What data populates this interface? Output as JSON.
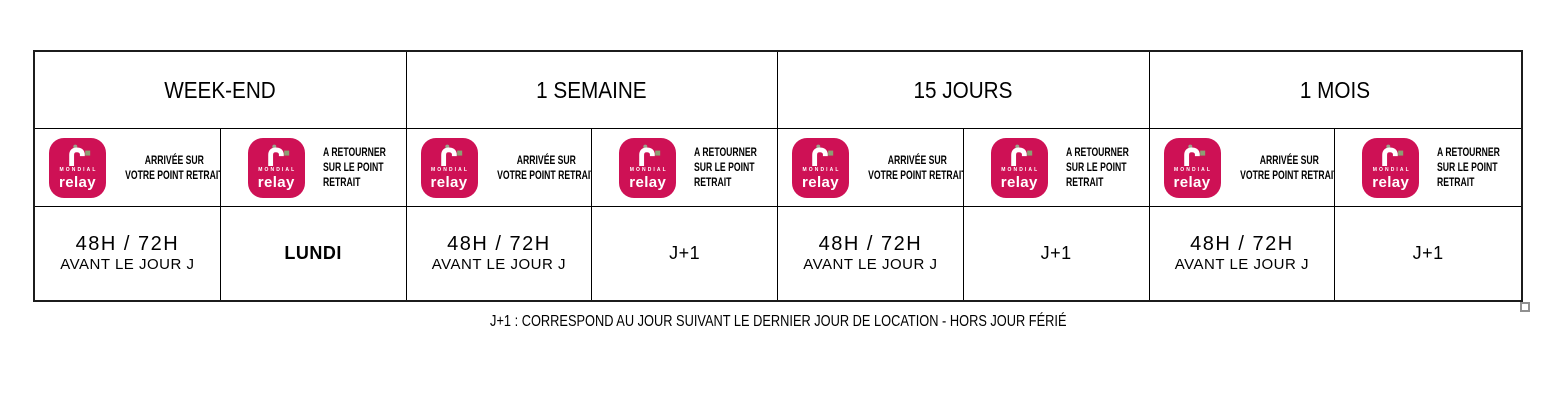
{
  "colors": {
    "brand_pink": "#ce1155",
    "brand_green": "#8c9e73",
    "dot_green": "#9ba68e"
  },
  "logo": {
    "brand_top": "MONDIAL",
    "brand_bottom": "relay"
  },
  "table": {
    "groups": [
      {
        "title": "WEEK-END",
        "arrival": {
          "label_line1": "ARRIVÉE SUR",
          "label_line2": "VOTRE POINT RETRAIT",
          "value_line1": "48H / 72H",
          "value_line2": "AVANT LE JOUR J"
        },
        "return": {
          "label_line1": "A RETOURNER",
          "label_line2": "SUR LE POINT",
          "label_line3": "RETRAIT",
          "value": "LUNDI"
        }
      },
      {
        "title": "1 SEMAINE",
        "arrival": {
          "label_line1": "ARRIVÉE SUR",
          "label_line2": "VOTRE POINT RETRAIT",
          "value_line1": "48H / 72H",
          "value_line2": "AVANT LE JOUR J"
        },
        "return": {
          "label_line1": "A RETOURNER",
          "label_line2": "SUR LE POINT",
          "label_line3": "RETRAIT",
          "value": "J+1"
        }
      },
      {
        "title": "15 JOURS",
        "arrival": {
          "label_line1": "ARRIVÉE SUR",
          "label_line2": "VOTRE POINT RETRAIT",
          "value_line1": "48H / 72H",
          "value_line2": "AVANT LE JOUR J"
        },
        "return": {
          "label_line1": "A RETOURNER",
          "label_line2": "SUR LE POINT",
          "label_line3": "RETRAIT",
          "value": "J+1"
        }
      },
      {
        "title": "1 MOIS",
        "arrival": {
          "label_line1": "ARRIVÉE SUR",
          "label_line2": "VOTRE POINT RETRAIT",
          "value_line1": "48H / 72H",
          "value_line2": "AVANT LE JOUR J"
        },
        "return": {
          "label_line1": "A RETOURNER",
          "label_line2": "SUR LE POINT",
          "label_line3": "RETRAIT",
          "value": "J+1"
        }
      }
    ]
  },
  "footnote": "J+1 : CORRESPOND AU JOUR SUIVANT LE DERNIER JOUR DE LOCATION - HORS JOUR FÉRIÉ"
}
